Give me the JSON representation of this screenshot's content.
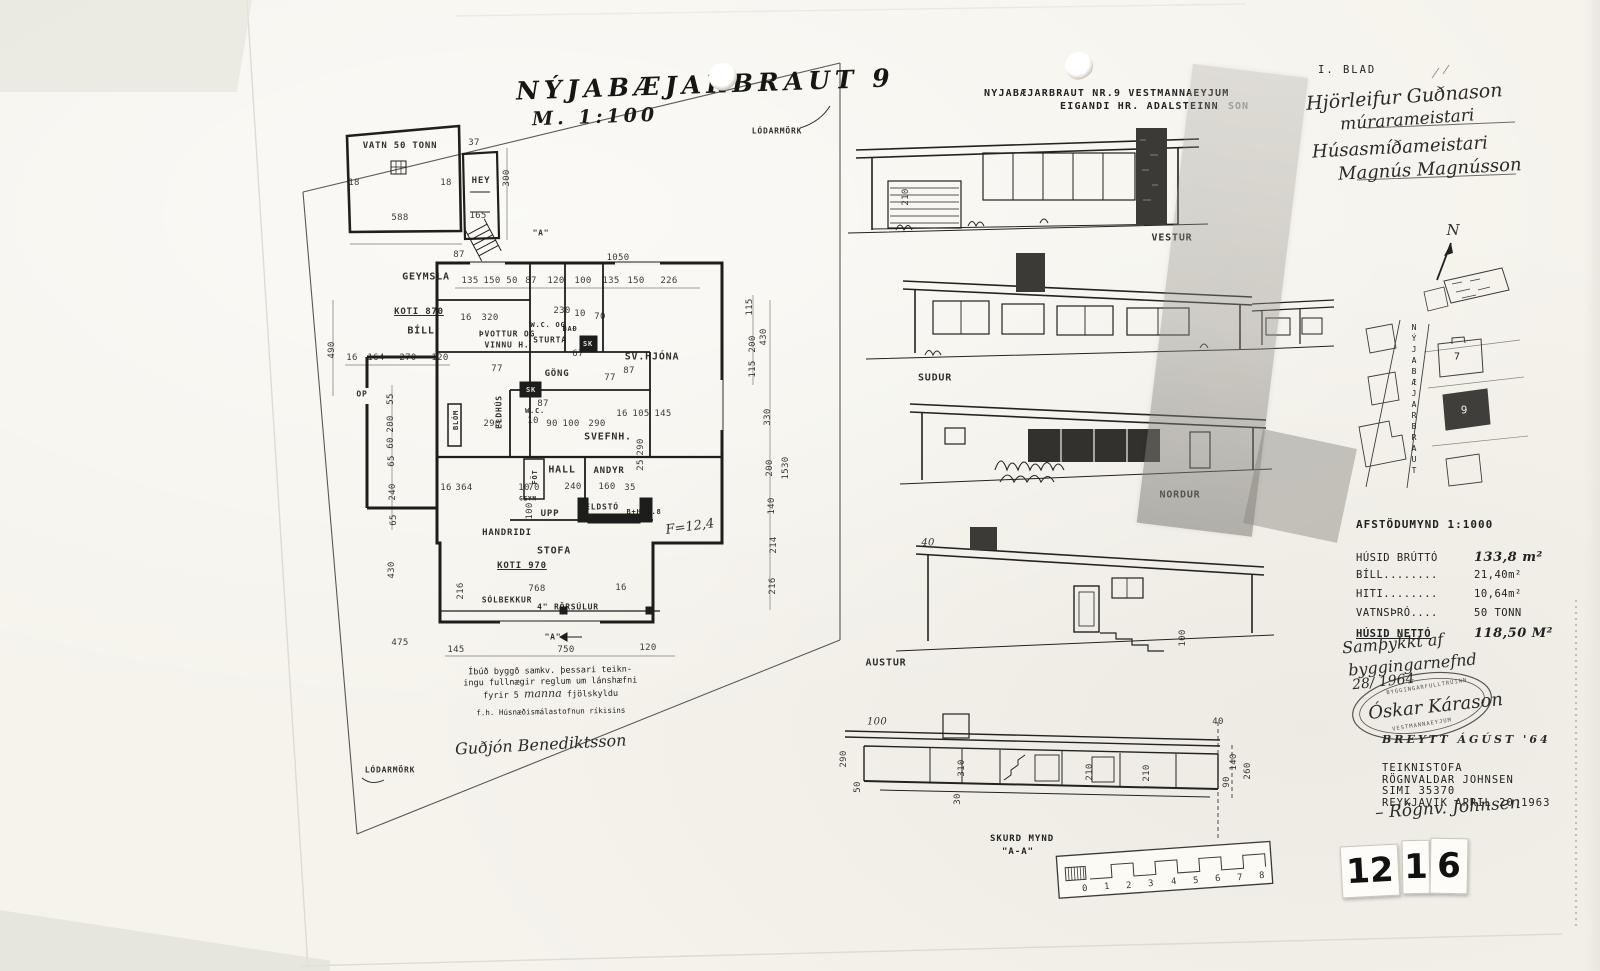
{
  "sheet": {
    "hand_title": "NÝJABÆJARBRAUT 9",
    "hand_scale": "M. 1:100",
    "blad": "I. BLAD",
    "typed_title_line1": "NYJABÆJARBRAUT NR.9 VESTMANNAEYJUM",
    "typed_title_line2": "EIGANDI HR. ADALSTEINN",
    "typed_title_obscured": "SON",
    "stamp_digits": [
      "12",
      "1",
      "6"
    ]
  },
  "signatures": {
    "mason_name": "Hjörleifur Guðnason",
    "mason_title": "múrarameistari",
    "carpenter_title": "Húsasmíðameistari",
    "carpenter_name": "Magnús Magnússon",
    "approval_line1": "Samþykkt af",
    "approval_line2": "byggingarnefnd",
    "approval_date": "28/ 1964",
    "inspector_signature": "Óskar Kárason",
    "stamp_text_top": "BYGGINGARFULLTRÚINN",
    "stamp_text_bottom": "VESTMANNAEYJUM",
    "breytt_note": "BREYTT ÁGÚST '64",
    "drafts_signature": "– Rögnv. Johnsen",
    "note_line1": "Íbúð byggð samkv. þessari teikn-",
    "note_line2": "ingu fullnægir reglum um lánshæfni",
    "note_line3a": "fyrir 5",
    "note_line3_hand": "manna",
    "note_line3b": "fjölskyldu",
    "note_agency": "f.h. Húsnæðismálastofnun ríkisins",
    "note_signature": "Guðjón Benediktsson"
  },
  "office": {
    "line1": "TEIKNISTOFA",
    "line2": "RÖGNVALDAR JOHNSEN",
    "line3": "SIMI 35370",
    "line4": "REYKJAVIK APRIL 20 1963"
  },
  "stats": {
    "rows": [
      {
        "label": "HÚSID BRÚTTÓ",
        "value": "133,8 m²"
      },
      {
        "label": "BÍLL........",
        "value": "21,40m²"
      },
      {
        "label": "HITI........",
        "value": "10,64m²"
      },
      {
        "label": "VATNSÞRÓ....",
        "value": "50 TONN"
      },
      {
        "label": "HÚSID NETTÓ",
        "value": "118,50 M²"
      }
    ]
  },
  "site": {
    "afstodumynd": "AFSTÖDUMYND 1:1000",
    "labels": [
      {
        "t": "N",
        "x": 1453,
        "y": 230,
        "c": "hand",
        "s": 15
      },
      {
        "t": "NÝJABÆJARBRAUT",
        "x": 1414,
        "y": 400,
        "c": "vert",
        "s": 8
      },
      {
        "t": "7",
        "x": 1457,
        "y": 357,
        "s": 10
      },
      {
        "t": "9",
        "x": 1464,
        "y": 410,
        "s": 11,
        "c": "white"
      }
    ]
  },
  "elevations": {
    "labels": [
      {
        "t": "VESTUR",
        "x": 1172,
        "y": 238
      },
      {
        "t": "SUDUR",
        "x": 935,
        "y": 378
      },
      {
        "t": "NORDUR",
        "x": 1180,
        "y": 495
      },
      {
        "t": "AUSTUR",
        "x": 886,
        "y": 663
      }
    ],
    "dims": [
      {
        "t": "210",
        "x": 906,
        "y": 197,
        "r": -90
      },
      {
        "t": "40",
        "x": 928,
        "y": 543,
        "c": "hand",
        "s": 10
      },
      {
        "t": "100",
        "x": 1183,
        "y": 638,
        "r": -90
      }
    ]
  },
  "section": {
    "label1": "SKURD MYND",
    "label2": "\"A-A\"",
    "dims": [
      {
        "t": "100",
        "x": 877,
        "y": 722,
        "c": "hand",
        "s": 10
      },
      {
        "t": "290",
        "x": 844,
        "y": 759,
        "r": -90
      },
      {
        "t": "50",
        "x": 858,
        "y": 787,
        "r": -90
      },
      {
        "t": "310",
        "x": 962,
        "y": 768,
        "r": -90
      },
      {
        "t": "30",
        "x": 958,
        "y": 799,
        "r": -90
      },
      {
        "t": "210",
        "x": 1090,
        "y": 772,
        "r": -90
      },
      {
        "t": "210",
        "x": 1147,
        "y": 773,
        "r": -90
      },
      {
        "t": "40",
        "x": 1218,
        "y": 722
      },
      {
        "t": "140",
        "x": 1234,
        "y": 762,
        "r": -90
      },
      {
        "t": "90",
        "x": 1227,
        "y": 782,
        "r": -90
      },
      {
        "t": "260",
        "x": 1248,
        "y": 771,
        "r": -90
      }
    ],
    "scale_ticks": [
      {
        "t": "0",
        "x": 1085,
        "y": 889,
        "r": -4
      },
      {
        "t": "1",
        "x": 1107,
        "y": 887,
        "r": -4
      },
      {
        "t": "2",
        "x": 1129,
        "y": 886,
        "r": -4
      },
      {
        "t": "3",
        "x": 1151,
        "y": 884,
        "r": -4
      },
      {
        "t": "4",
        "x": 1174,
        "y": 882,
        "r": -4
      },
      {
        "t": "5",
        "x": 1196,
        "y": 881,
        "r": -4
      },
      {
        "t": "6",
        "x": 1218,
        "y": 879,
        "r": -4
      },
      {
        "t": "7",
        "x": 1240,
        "y": 878,
        "r": -4
      },
      {
        "t": "8",
        "x": 1262,
        "y": 876,
        "r": -4
      }
    ]
  },
  "floor_plan": {
    "rooms": [
      {
        "t": "VATN 50 TONN",
        "x": 400,
        "y": 146,
        "s": 9
      },
      {
        "t": "HEY",
        "x": 481,
        "y": 181,
        "s": 9
      },
      {
        "t": "GEYMSLA",
        "x": 426,
        "y": 277
      },
      {
        "t": "KOTI 870",
        "x": 419,
        "y": 312,
        "u": 1,
        "s": 9
      },
      {
        "t": "BÍLL",
        "x": 421,
        "y": 331
      },
      {
        "t": "ÞVOTTUR OG",
        "x": 507,
        "y": 334,
        "s": 8
      },
      {
        "t": "VINNU H.",
        "x": 507,
        "y": 345,
        "s": 8
      },
      {
        "t": "W.C. OG",
        "x": 548,
        "y": 325,
        "s": 7
      },
      {
        "t": "STURTA",
        "x": 550,
        "y": 340,
        "s": 8
      },
      {
        "t": "BAÐ",
        "x": 570,
        "y": 329,
        "s": 7
      },
      {
        "t": "SK",
        "x": 588,
        "y": 344,
        "s": 7,
        "c": "white"
      },
      {
        "t": "SK",
        "x": 531,
        "y": 390,
        "s": 7,
        "c": "white"
      },
      {
        "t": "GÖNG",
        "x": 557,
        "y": 374,
        "s": 9
      },
      {
        "t": "SV.HJÓNA",
        "x": 652,
        "y": 357
      },
      {
        "t": "ELDHÚS",
        "x": 499,
        "y": 412,
        "r": -90,
        "s": 8
      },
      {
        "t": "BLÓM",
        "x": 456,
        "y": 420,
        "r": -90,
        "s": 7
      },
      {
        "t": "W.C.",
        "x": 535,
        "y": 411,
        "s": 7
      },
      {
        "t": "SVEFNH.",
        "x": 608,
        "y": 437
      },
      {
        "t": "HALL",
        "x": 562,
        "y": 470
      },
      {
        "t": "ANDYR",
        "x": 609,
        "y": 471,
        "s": 9
      },
      {
        "t": "FÖT",
        "x": 535,
        "y": 477,
        "r": -90,
        "s": 7
      },
      {
        "t": "GEYM",
        "x": 528,
        "y": 499,
        "s": 6
      },
      {
        "t": "UPP",
        "x": 550,
        "y": 514,
        "s": 9
      },
      {
        "t": "ELDSTÓ",
        "x": 602,
        "y": 507,
        "s": 8
      },
      {
        "t": "B+H 4.8",
        "x": 644,
        "y": 512,
        "s": 7
      },
      {
        "t": "HANDRIDI",
        "x": 507,
        "y": 533,
        "s": 9
      },
      {
        "t": "STOFA",
        "x": 554,
        "y": 551
      },
      {
        "t": "KOTI 970",
        "x": 522,
        "y": 566,
        "u": 1,
        "s": 9
      },
      {
        "t": "SÓLBEKKUR",
        "x": 507,
        "y": 600,
        "s": 8
      },
      {
        "t": "4\" RÖRSÚLUR",
        "x": 568,
        "y": 607,
        "s": 8
      },
      {
        "t": "OP",
        "x": 362,
        "y": 394,
        "s": 8
      },
      {
        "t": "\"A\"",
        "x": 541,
        "y": 233,
        "s": 8
      },
      {
        "t": "\"A\"",
        "x": 553,
        "y": 637,
        "s": 8
      },
      {
        "t": "LÓDARMÖRK",
        "x": 777,
        "y": 131,
        "s": 8
      },
      {
        "t": "LÓDARMÖRK",
        "x": 390,
        "y": 770,
        "s": 8
      }
    ],
    "dims": [
      {
        "t": "37",
        "x": 474,
        "y": 143
      },
      {
        "t": "300",
        "x": 507,
        "y": 178,
        "r": -90
      },
      {
        "t": "18",
        "x": 354,
        "y": 183
      },
      {
        "t": "18",
        "x": 446,
        "y": 183
      },
      {
        "t": "588",
        "x": 400,
        "y": 218
      },
      {
        "t": "165",
        "x": 478,
        "y": 216
      },
      {
        "t": "490",
        "x": 332,
        "y": 350,
        "r": -90
      },
      {
        "t": "87",
        "x": 459,
        "y": 255
      },
      {
        "t": "1050",
        "x": 618,
        "y": 258
      },
      {
        "t": "135",
        "x": 470,
        "y": 281
      },
      {
        "t": "150",
        "x": 492,
        "y": 281
      },
      {
        "t": "50",
        "x": 512,
        "y": 281
      },
      {
        "t": "87",
        "x": 531,
        "y": 281
      },
      {
        "t": "120",
        "x": 556,
        "y": 281
      },
      {
        "t": "100",
        "x": 583,
        "y": 281
      },
      {
        "t": "135",
        "x": 611,
        "y": 281
      },
      {
        "t": "150",
        "x": 636,
        "y": 281
      },
      {
        "t": "226",
        "x": 669,
        "y": 281
      },
      {
        "t": "16",
        "x": 352,
        "y": 358
      },
      {
        "t": "164",
        "x": 376,
        "y": 358
      },
      {
        "t": "270",
        "x": 408,
        "y": 358
      },
      {
        "t": "120",
        "x": 440,
        "y": 358
      },
      {
        "t": "55",
        "x": 391,
        "y": 399,
        "r": -90
      },
      {
        "t": "200",
        "x": 391,
        "y": 424,
        "r": -90
      },
      {
        "t": "60",
        "x": 391,
        "y": 443,
        "r": -90
      },
      {
        "t": "65",
        "x": 392,
        "y": 461,
        "r": -90
      },
      {
        "t": "240",
        "x": 393,
        "y": 492,
        "r": -90
      },
      {
        "t": "65",
        "x": 394,
        "y": 520,
        "r": -90
      },
      {
        "t": "430",
        "x": 392,
        "y": 570,
        "r": -90
      },
      {
        "t": "475",
        "x": 400,
        "y": 643
      },
      {
        "t": "145",
        "x": 456,
        "y": 650
      },
      {
        "t": "16",
        "x": 466,
        "y": 318
      },
      {
        "t": "320",
        "x": 490,
        "y": 318
      },
      {
        "t": "230",
        "x": 562,
        "y": 311
      },
      {
        "t": "10",
        "x": 580,
        "y": 314
      },
      {
        "t": "70",
        "x": 600,
        "y": 317
      },
      {
        "t": "77",
        "x": 497,
        "y": 369
      },
      {
        "t": "67",
        "x": 578,
        "y": 354
      },
      {
        "t": "77",
        "x": 610,
        "y": 378
      },
      {
        "t": "87",
        "x": 629,
        "y": 371
      },
      {
        "t": "290",
        "x": 492,
        "y": 424
      },
      {
        "t": "87",
        "x": 543,
        "y": 404
      },
      {
        "t": "10",
        "x": 533,
        "y": 421
      },
      {
        "t": "90",
        "x": 552,
        "y": 424
      },
      {
        "t": "100",
        "x": 571,
        "y": 424
      },
      {
        "t": "290",
        "x": 597,
        "y": 424
      },
      {
        "t": "16",
        "x": 622,
        "y": 414
      },
      {
        "t": "105",
        "x": 641,
        "y": 414
      },
      {
        "t": "145",
        "x": 663,
        "y": 414
      },
      {
        "t": "290",
        "x": 641,
        "y": 447,
        "r": -90
      },
      {
        "t": "25",
        "x": 641,
        "y": 465,
        "r": -90
      },
      {
        "t": "16",
        "x": 446,
        "y": 488
      },
      {
        "t": "364",
        "x": 464,
        "y": 488
      },
      {
        "t": "10",
        "x": 524,
        "y": 488
      },
      {
        "t": "70",
        "x": 534,
        "y": 488
      },
      {
        "t": "240",
        "x": 573,
        "y": 487
      },
      {
        "t": "160",
        "x": 607,
        "y": 487
      },
      {
        "t": "35",
        "x": 630,
        "y": 488
      },
      {
        "t": "100",
        "x": 530,
        "y": 511,
        "r": -90
      },
      {
        "t": "216",
        "x": 461,
        "y": 591,
        "r": -90
      },
      {
        "t": "768",
        "x": 537,
        "y": 589
      },
      {
        "t": "16",
        "x": 621,
        "y": 588
      },
      {
        "t": "750",
        "x": 566,
        "y": 650
      },
      {
        "t": "120",
        "x": 648,
        "y": 648
      },
      {
        "t": "115",
        "x": 750,
        "y": 307,
        "r": -90
      },
      {
        "t": "200",
        "x": 753,
        "y": 344,
        "r": -90
      },
      {
        "t": "430",
        "x": 764,
        "y": 337,
        "r": -90
      },
      {
        "t": "115",
        "x": 753,
        "y": 369,
        "r": -90
      },
      {
        "t": "330",
        "x": 768,
        "y": 417,
        "r": -90
      },
      {
        "t": "200",
        "x": 770,
        "y": 468,
        "r": -90
      },
      {
        "t": "1530",
        "x": 786,
        "y": 468,
        "r": -90
      },
      {
        "t": "140",
        "x": 772,
        "y": 506,
        "r": -90
      },
      {
        "t": "214",
        "x": 774,
        "y": 545,
        "r": -90
      },
      {
        "t": "216",
        "x": 773,
        "y": 586,
        "r": -90
      }
    ],
    "hand_notes": [
      {
        "t": "F=12,4",
        "x": 690,
        "y": 527,
        "r": -8,
        "s": 13,
        "c": "hand"
      }
    ]
  }
}
